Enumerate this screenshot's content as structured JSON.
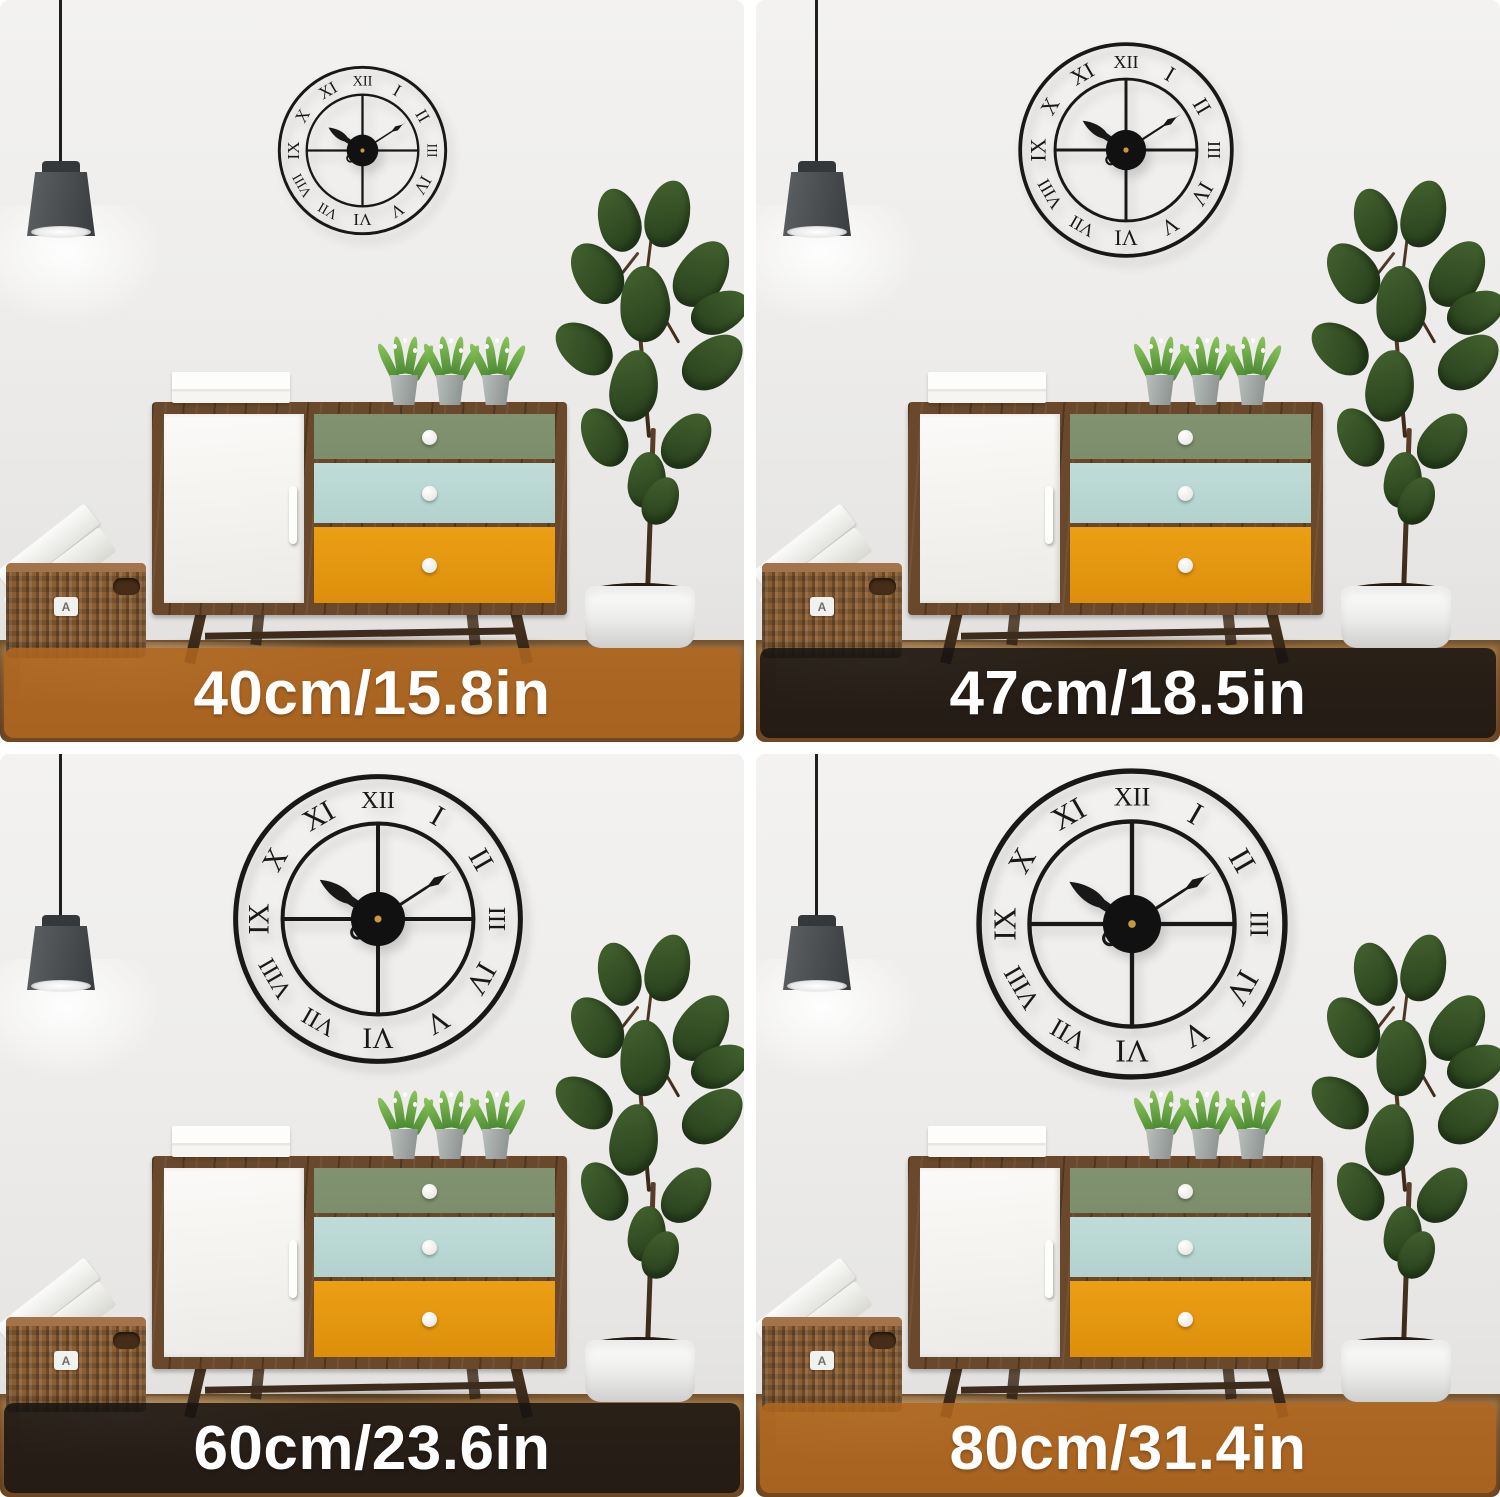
{
  "panels": [
    {
      "size_label": "40cm/15.8in",
      "bar_color": "rgba(175,102,32,0.88)",
      "clock_scale_px": 173
    },
    {
      "size_label": "47cm/18.5in",
      "bar_color": "rgba(24,21,18,0.87)",
      "clock_scale_px": 220
    },
    {
      "size_label": "60cm/23.6in",
      "bar_color": "rgba(24,21,18,0.87)",
      "clock_scale_px": 296
    },
    {
      "size_label": "80cm/31.4in",
      "bar_color": "rgba(175,102,32,0.88)",
      "clock_scale_px": 318
    }
  ],
  "clock": {
    "numerals": [
      "XII",
      "I",
      "II",
      "III",
      "IV",
      "V",
      "VI",
      "VII",
      "VIII",
      "IX",
      "X",
      "XI"
    ],
    "hour_hand_angle": 304,
    "minute_hand_angle": 57,
    "metal_color": "#181818",
    "hub_pin_color": "#c49a3c"
  },
  "basket": {
    "label": "A"
  }
}
